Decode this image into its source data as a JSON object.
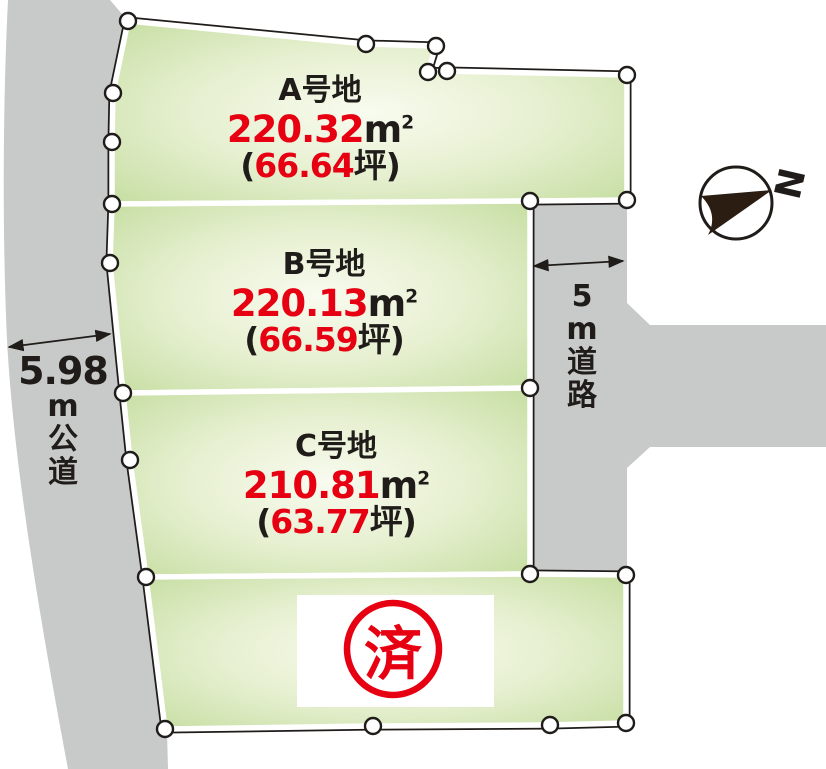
{
  "plots": [
    {
      "id": "A",
      "name": "A号地",
      "area_m2": "220.32",
      "area_tsubo": "66.64"
    },
    {
      "id": "B",
      "name": "B号地",
      "area_m2": "220.13",
      "area_tsubo": "66.59"
    },
    {
      "id": "C",
      "name": "C号地",
      "area_m2": "210.81",
      "area_tsubo": "63.77"
    }
  ],
  "sold_plot": {
    "stamp": "済"
  },
  "units": {
    "sqm_base": "m",
    "sqm_sup": "2",
    "paren_open": "(",
    "tsubo_close": "坪)"
  },
  "roads": {
    "left": {
      "width": "5.98",
      "name": "m公道"
    },
    "right": {
      "name": "5m道路"
    }
  },
  "compass": {
    "label": "N"
  },
  "colors": {
    "accent_red": "#e60012",
    "line_dark": "#1f1c1a",
    "road_gray": "#c8c9c9",
    "grass_green": "#2fa87c",
    "plot_green_edge": "#c8dfa5"
  }
}
